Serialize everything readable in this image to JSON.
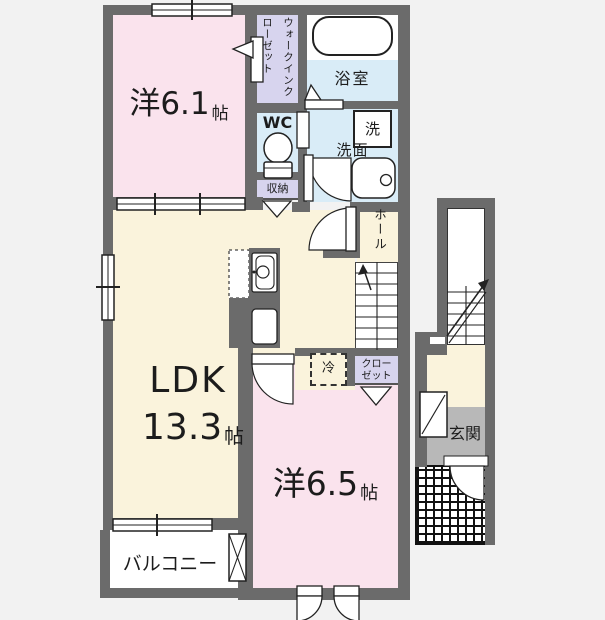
{
  "rooms": {
    "bedroom1": {
      "name": "洋6.1",
      "unit": "帖"
    },
    "walk_in_closet": {
      "name": "ウォークインクローゼット"
    },
    "bathroom": {
      "name": "浴室"
    },
    "toilet": {
      "name": "WC"
    },
    "washroom": {
      "name": "洗面"
    },
    "washer": {
      "name": "洗"
    },
    "storage": {
      "name": "収納"
    },
    "hall": {
      "name": "ホール"
    },
    "ldk": {
      "name": "LDK",
      "size": "13.3",
      "unit": "帖"
    },
    "refrigerator": {
      "name": "冷"
    },
    "closet": {
      "line1": "クロー",
      "line2": "ゼット"
    },
    "bedroom2": {
      "name": "洋6.5",
      "unit": "帖"
    },
    "balcony": {
      "name": "バルコニー"
    },
    "entrance": {
      "name": "玄関"
    }
  },
  "colors": {
    "wall": "#6b6b6b",
    "room_pink": "#fae3ed",
    "room_cream": "#faf3dc",
    "room_blue": "#d9ecf7",
    "room_lavender": "#d7d4ee",
    "entrance_gray": "#b8b8b8",
    "background": "#f2f2f2",
    "line": "#1c1c1c"
  }
}
